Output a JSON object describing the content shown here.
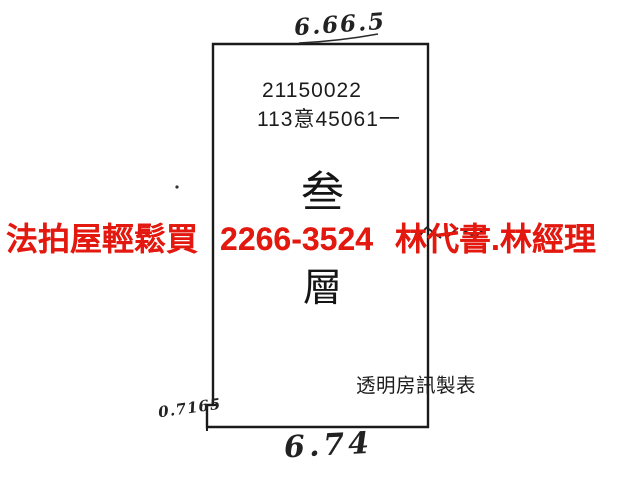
{
  "page": {
    "background_color": "#ffffff",
    "line_color": "#1a1a1a",
    "handwriting_color": "#222222"
  },
  "floor_plan": {
    "parcel_numbers": {
      "line1": "21150022",
      "line2": "113意45061一"
    },
    "floor_label": {
      "char_top": "叁",
      "char_bottom": "層"
    },
    "maker_label": "透明房訊製表",
    "dimensions": {
      "top_width": "6.66.5",
      "bottom_width": "6.74",
      "left_notch": "0.7165"
    }
  },
  "overlay_ad": {
    "brand": "法拍屋輕鬆買",
    "phone": "2266-3524",
    "contact": "林代書.林經理",
    "color": "#e31910"
  }
}
